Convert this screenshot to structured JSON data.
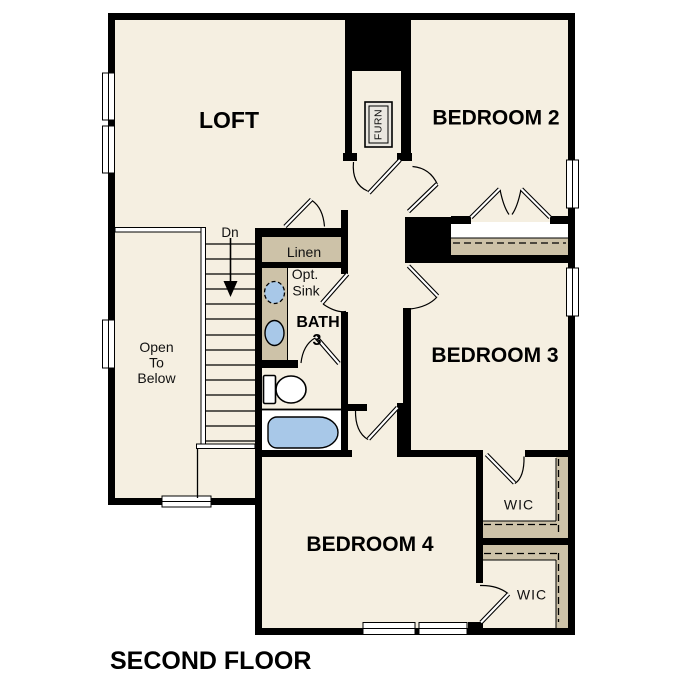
{
  "plan_title": "SECOND FLOOR",
  "rooms": {
    "loft": {
      "label": "LOFT"
    },
    "bedroom2": {
      "label": "BEDROOM 2"
    },
    "bedroom3": {
      "label": "BEDROOM 3"
    },
    "bedroom4": {
      "label": "BEDROOM 4"
    },
    "bath3": {
      "name": "BATH",
      "number": "3"
    },
    "linen": {
      "label": "Linen"
    },
    "wic_upper": {
      "label": "WIC"
    },
    "wic_lower": {
      "label": "WIC"
    },
    "open_to_below": {
      "line1": "Open",
      "line2": "To",
      "line3": "Below"
    },
    "furnace": {
      "label": "FURN"
    }
  },
  "annotations": {
    "stair_direction": "Dn",
    "optional_sink_line1": "Opt.",
    "optional_sink_line2": "Sink"
  },
  "colors": {
    "background": "#ffffff",
    "floor": "#f5efe1",
    "shelf": "#cdc2a8",
    "blue": "#a8c8e8",
    "wall": "#000000",
    "equipment": "#eae7e0"
  }
}
